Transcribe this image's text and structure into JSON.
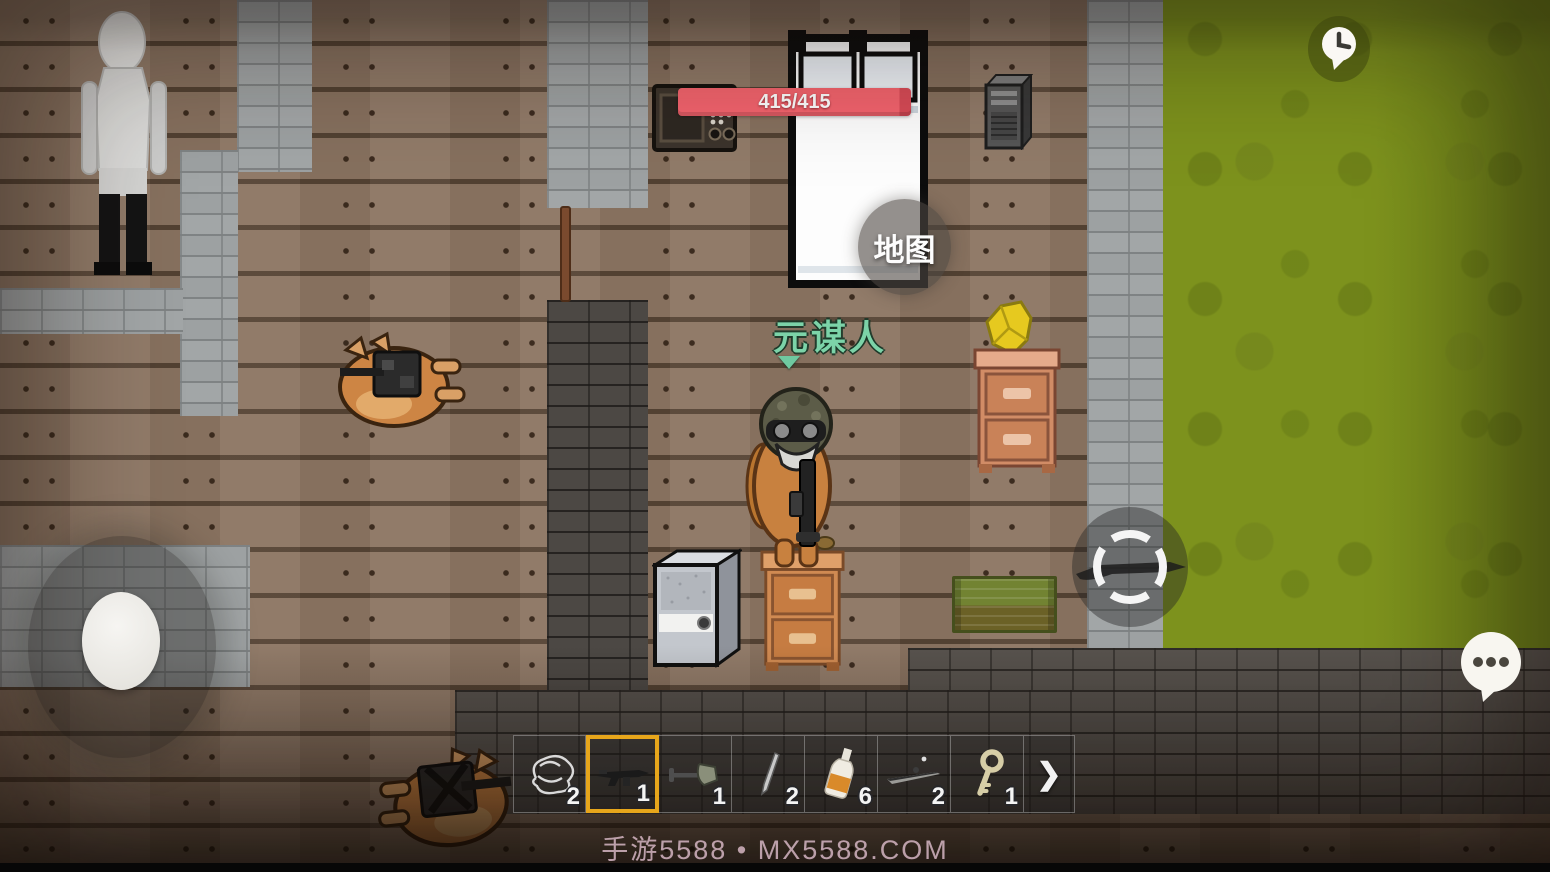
{
  "hud": {
    "health_bar": {
      "value": "415/415",
      "color": "#f4646e"
    },
    "map_button": {
      "label": "地图"
    },
    "player": {
      "name": "元谋人",
      "name_color": "#7cd3a8"
    },
    "hotbar": {
      "selected_border_color": "#e7a61b",
      "slots": [
        {
          "item": "rope-tangle",
          "count": "2",
          "selected": false
        },
        {
          "item": "rifle",
          "count": "1",
          "selected": true
        },
        {
          "item": "shovel",
          "count": "1",
          "selected": false
        },
        {
          "item": "knife",
          "count": "2",
          "selected": false
        },
        {
          "item": "bottle",
          "count": "6",
          "selected": false
        },
        {
          "item": "sniper-rifle",
          "count": "2",
          "selected": false
        },
        {
          "item": "key",
          "count": "1",
          "selected": false
        }
      ],
      "expand_label": "❯"
    },
    "icons": [
      "clock-icon",
      "chat-bubble-icon",
      "crosshair-icon",
      "chevron-right-icon"
    ]
  },
  "watermark": {
    "text": "手游5588 • MX5588.COM"
  },
  "environment": {
    "grass_color": "#7d921d",
    "floor": "wood-planks",
    "walls": "gray-brick"
  }
}
